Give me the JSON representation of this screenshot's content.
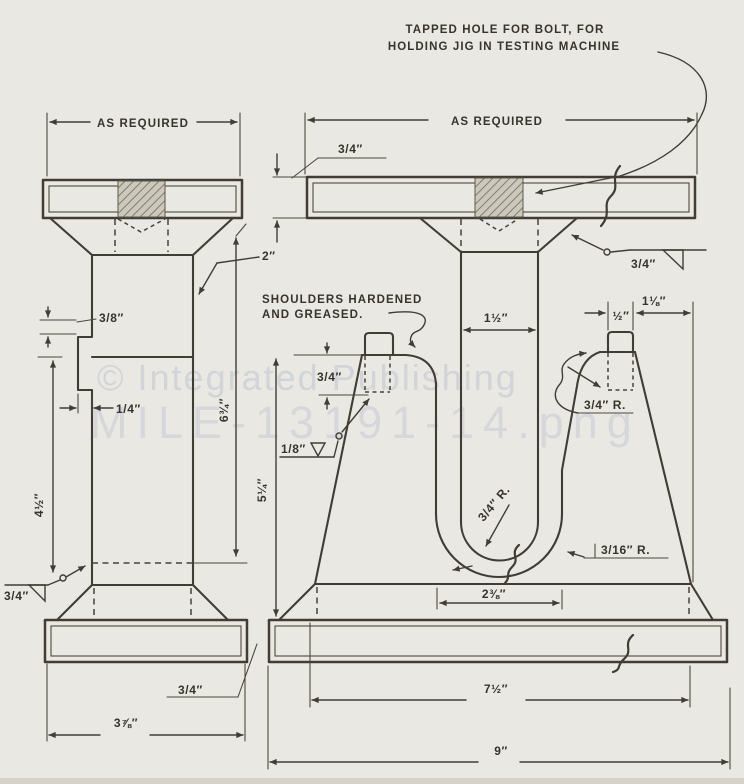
{
  "notes": {
    "tapped_hole_1": "TAPPED HOLE FOR BOLT, FOR",
    "tapped_hole_2": "HOLDING JIG IN TESTING MACHINE",
    "shoulders_1": "SHOULDERS HARDENED",
    "shoulders_2": "AND GREASED."
  },
  "left_view": {
    "as_required": "AS REQUIRED",
    "col_width": "2″",
    "step_height": "3/8″",
    "tab_width": "1/4″",
    "col_height": "6¾″",
    "lower_height": "4½″",
    "weld_size": "3/4″",
    "base_thickness": "3/4″",
    "base_width": "3⅞″"
  },
  "right_view": {
    "as_required": "AS REQUIRED",
    "plate_thickness": "3/4″",
    "weld_size": "3/4″",
    "stem_width": "1½″",
    "shoulder_width": "½″",
    "post_top_width": "1⅛″",
    "shoulder_depth": "3/4″",
    "weld_size_small": "1/8″",
    "post_radius": "3/4″ R.",
    "stem_radius": "3/4″ R.",
    "slot_radius": "3/16″ R.",
    "body_height": "5¼″",
    "slot_width": "2⅜″",
    "body_width": "7½″",
    "base_width": "9″"
  },
  "watermark": {
    "line1": "© Integrated Publishing",
    "line2": "MILE-13191-14.png"
  },
  "colors": {
    "paper": "#eae8e3",
    "ink": "#403d35",
    "watermark": "#c3c9d3"
  }
}
